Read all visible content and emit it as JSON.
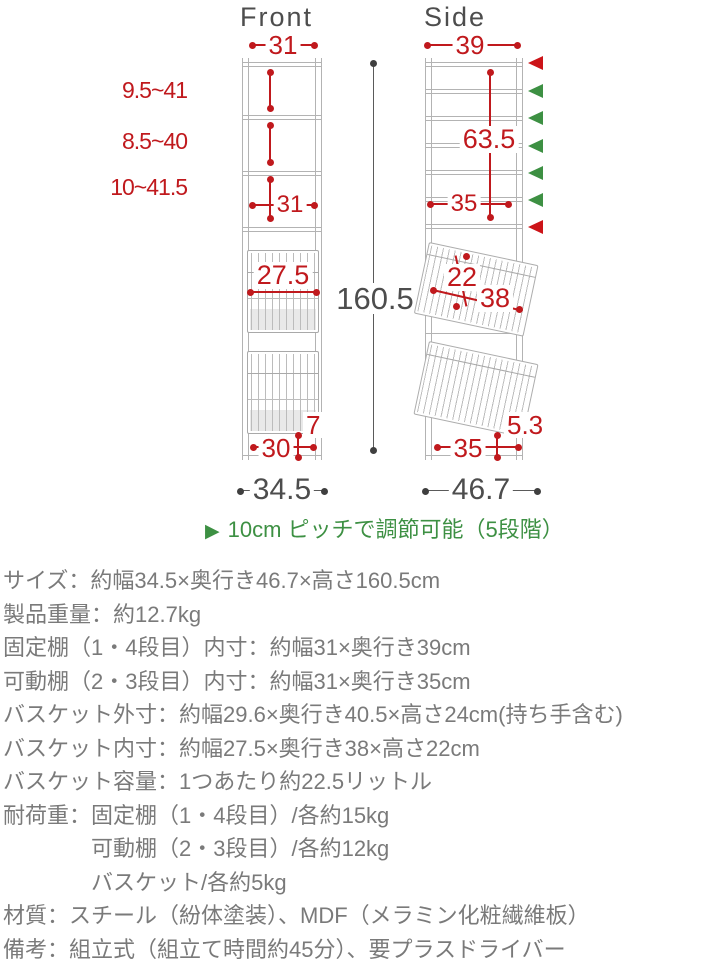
{
  "front_view": {
    "title": "Front",
    "top_inner_width": "31",
    "gap_range_1": "9.5~41",
    "gap_range_2": "8.5~40",
    "gap_range_3": "10~41.5",
    "mid_inner_width": "31",
    "basket_inner_width": "27.5",
    "bottom_inner_width": "30",
    "foot_height": "7",
    "total_width": "34.5"
  },
  "side_view": {
    "title": "Side",
    "top_inner_depth": "39",
    "shelf_span": "63.5",
    "inner_depth": "35",
    "basket_inner_height": "22",
    "basket_inner_depth": "38",
    "bottom_inner_depth": "35",
    "foot_clearance": "5.3",
    "total_depth": "46.7"
  },
  "total_height": "160.5",
  "note": {
    "bullet": "▶",
    "text": "10cm ピッチで調節可能（5段階）"
  },
  "specs": {
    "lines": [
      {
        "text": "サイズ：約幅34.5×奥行き46.7×高さ160.5cm"
      },
      {
        "text": "製品重量：約12.7kg"
      },
      {
        "text": "固定棚（1・4段目）内寸：約幅31×奥行き39cm"
      },
      {
        "text": "可動棚（2・3段目）内寸：約幅31×奥行き35cm"
      },
      {
        "text": "バスケット外寸：約幅29.6×奥行き40.5×高さ24cm(持ち手含む)"
      },
      {
        "text": "バスケット内寸：約幅27.5×奥行き38×高さ22cm"
      },
      {
        "text": "バスケット容量：1つあたり約22.5リットル"
      },
      {
        "text": "耐荷重：固定棚（1・4段目）/各約15kg"
      },
      {
        "text": "可動棚（2・3段目）/各約12kg"
      },
      {
        "text": "バスケット/各約5kg"
      },
      {
        "text": "材質：スチール（紛体塗装）、MDF（メラミン化粧繊維板）"
      },
      {
        "text": "備考：組立式（組立て時間約45分）、要プラスドライバー"
      }
    ]
  },
  "colors": {
    "dimension_red": "#c0191d",
    "adjustable_green": "#3d9043",
    "fixed_red_marker": "#cc1418",
    "frame_gray": "#b3b3b3",
    "spec_text_gray": "#7a7a7a",
    "dark_text_gray": "#4d4d4d"
  }
}
